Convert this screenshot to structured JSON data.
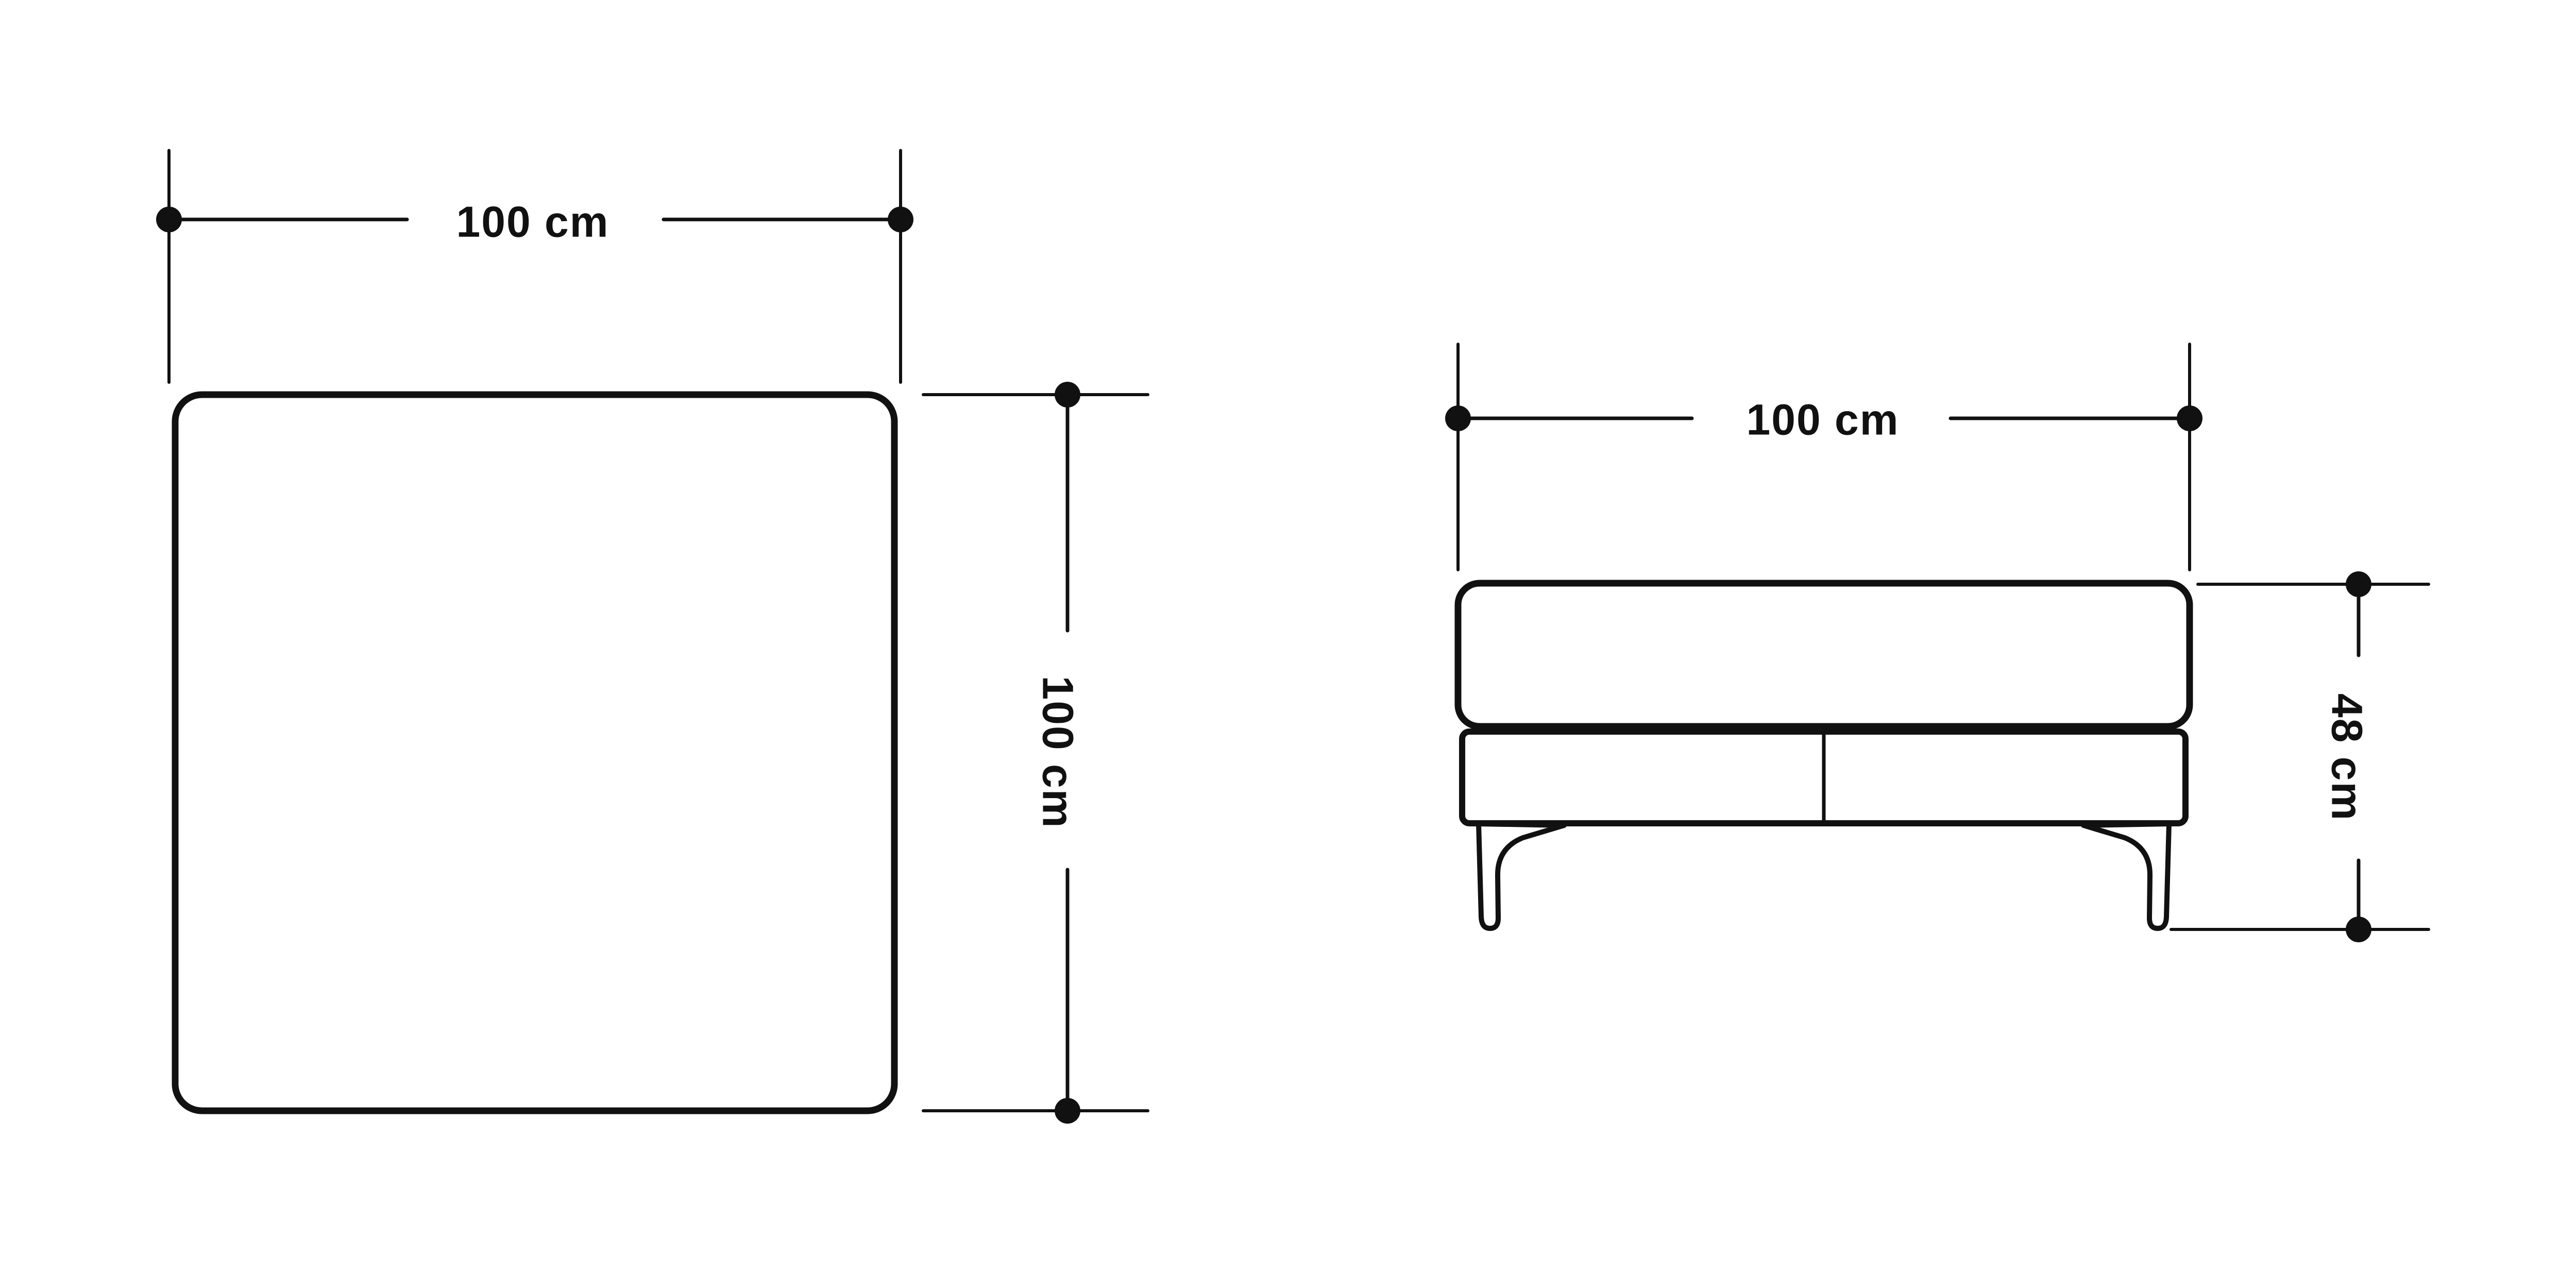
{
  "diagram": {
    "background_color": "#ffffff",
    "line_color": "#111111",
    "top_view": {
      "width_dimension": {
        "label": "100 cm",
        "value": 100,
        "unit": "cm"
      },
      "depth_dimension": {
        "label": "100 cm",
        "value": 100,
        "unit": "cm"
      }
    },
    "front_view": {
      "width_dimension": {
        "label": "100 cm",
        "value": 100,
        "unit": "cm"
      },
      "height_dimension": {
        "label": "48 cm",
        "value": 48,
        "unit": "cm"
      }
    }
  }
}
